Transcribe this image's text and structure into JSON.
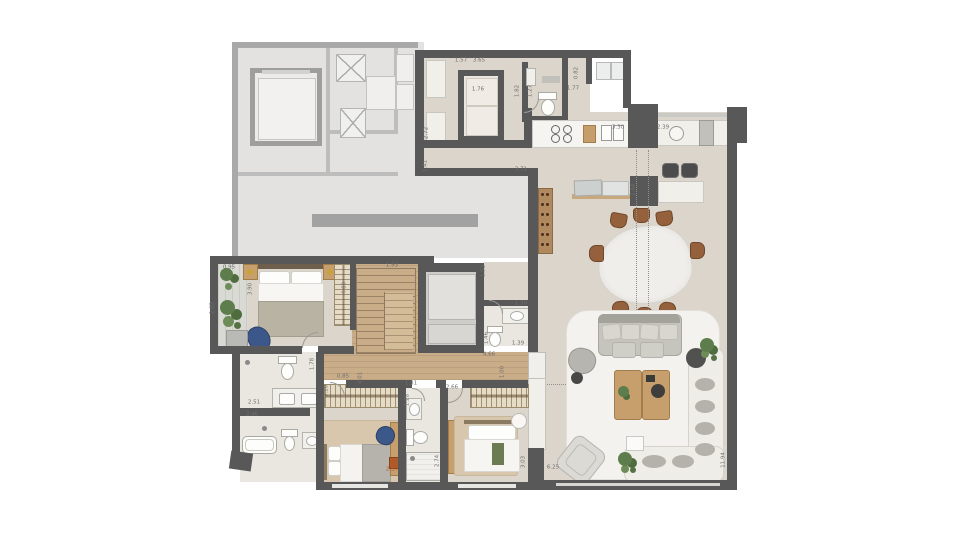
{
  "plan": {
    "type": "apartment-floor-plan",
    "colors": {
      "unit_wall": "#585858",
      "common_wall": "#a9a9a9",
      "floor": "#dcd5cc",
      "wood_floor": "#c9ac88",
      "marble": "#f1efea",
      "dimension_text": "#6e6e6e",
      "accent_dimension": "#b05a28",
      "plant_green": "#5e7d4c",
      "chair_brown": "#95613d",
      "armchair_blue": "#3c588a"
    },
    "dimensions": [
      {
        "t": "1.57",
        "x": 461,
        "y": 61
      },
      {
        "t": "3.65",
        "x": 479,
        "y": 61
      },
      {
        "t": "1.76",
        "x": 478,
        "y": 90
      },
      {
        "t": "1.82",
        "x": 518,
        "y": 91,
        "r": -90
      },
      {
        "t": "1.27",
        "x": 531,
        "y": 91,
        "r": -90
      },
      {
        "t": "0.82",
        "x": 577,
        "y": 73,
        "r": -90
      },
      {
        "t": "1.77",
        "x": 573,
        "y": 89
      },
      {
        "t": "2.72",
        "x": 427,
        "y": 133,
        "r": -90
      },
      {
        "t": "1.41",
        "x": 426,
        "y": 166,
        "r": -90
      },
      {
        "t": "3.71",
        "x": 521,
        "y": 170
      },
      {
        "t": "3.30",
        "x": 618,
        "y": 128
      },
      {
        "t": "2.39",
        "x": 663,
        "y": 128
      },
      {
        "t": "2.44",
        "x": 634,
        "y": 190,
        "r": -90
      },
      {
        "t": "1.93",
        "x": 392,
        "y": 266
      },
      {
        "t": "1.52",
        "x": 484,
        "y": 271,
        "r": -90
      },
      {
        "t": "1.50",
        "x": 521,
        "y": 304
      },
      {
        "t": "1.39",
        "x": 518,
        "y": 344
      },
      {
        "t": "1.46",
        "x": 487,
        "y": 338,
        "r": -90
      },
      {
        "t": "4.66",
        "x": 489,
        "y": 355
      },
      {
        "t": "0.95",
        "x": 229,
        "y": 268
      },
      {
        "t": "3.90",
        "x": 251,
        "y": 289,
        "r": -90
      },
      {
        "t": "4.60",
        "x": 345,
        "y": 288,
        "r": -90
      },
      {
        "t": "2.82",
        "x": 213,
        "y": 308,
        "r": -90
      },
      {
        "t": "1.78",
        "x": 313,
        "y": 364,
        "r": -90
      },
      {
        "t": "3.10",
        "x": 327,
        "y": 391,
        "r": -90
      },
      {
        "t": "2.51",
        "x": 254,
        "y": 403
      },
      {
        "t": "2.46",
        "x": 252,
        "y": 415
      },
      {
        "t": "0.85",
        "x": 343,
        "y": 377
      },
      {
        "t": "4.01",
        "x": 361,
        "y": 378,
        "r": -90
      },
      {
        "t": "1.31",
        "x": 411,
        "y": 384
      },
      {
        "t": "2.66",
        "x": 452,
        "y": 388
      },
      {
        "t": "1.28",
        "x": 408,
        "y": 400,
        "r": -90
      },
      {
        "t": "1.00",
        "x": 503,
        "y": 372,
        "r": -90
      },
      {
        "t": "2.74",
        "x": 438,
        "y": 461,
        "r": -90
      },
      {
        "t": "2.57",
        "x": 392,
        "y": 470,
        "c": "#b05a28"
      },
      {
        "t": "3.03",
        "x": 524,
        "y": 462,
        "r": -90
      },
      {
        "t": "6.25",
        "x": 553,
        "y": 468
      },
      {
        "t": "11.94",
        "x": 724,
        "y": 460,
        "r": -90
      }
    ]
  }
}
